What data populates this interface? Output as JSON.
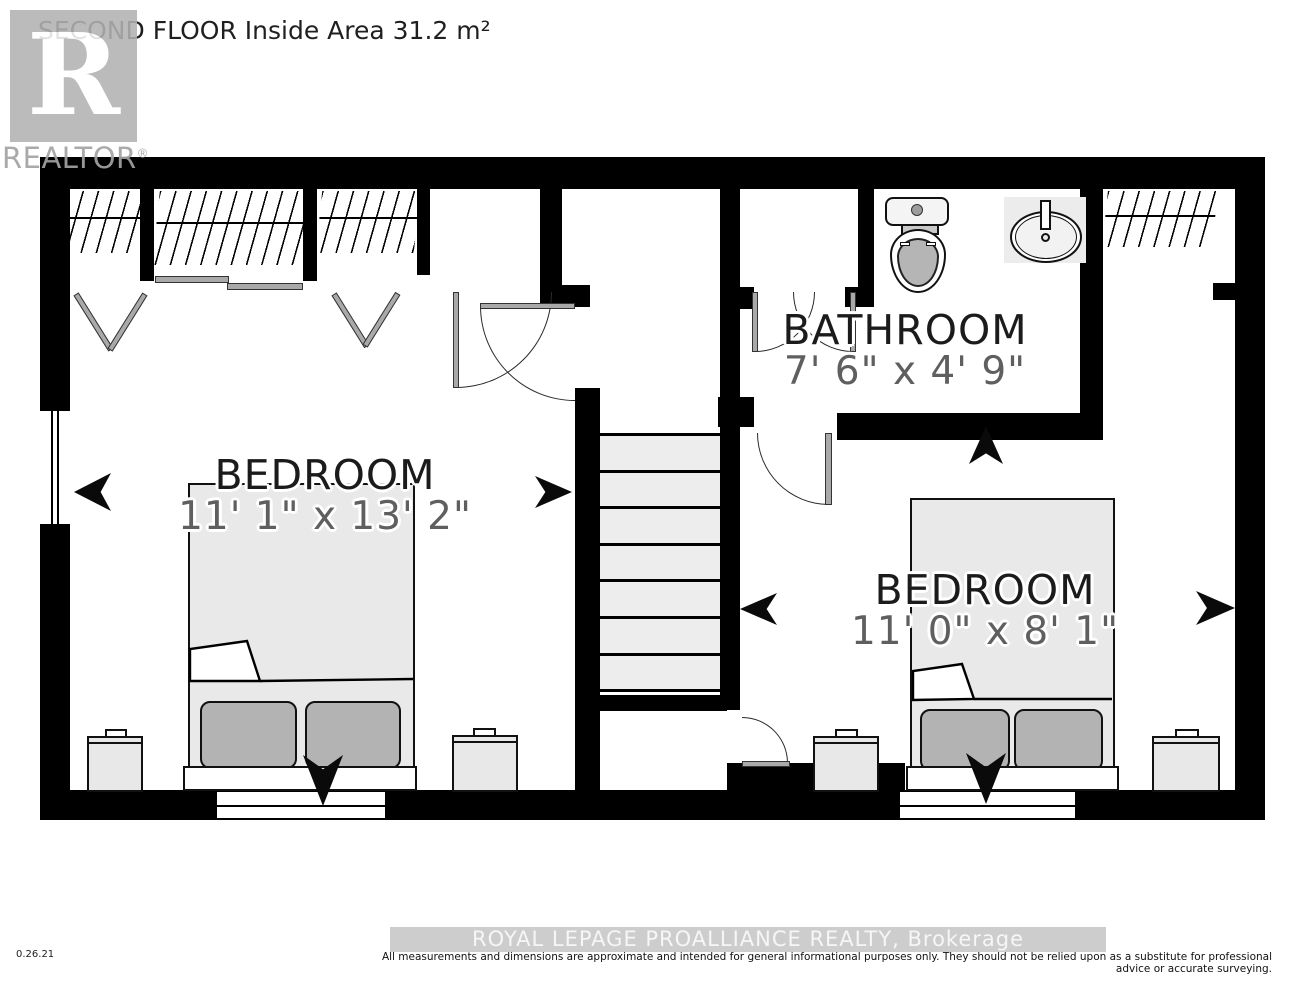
{
  "title": "SECOND FLOOR Inside Area 31.2 m²",
  "logo": {
    "letter": "R",
    "label": "REALTOR",
    "registered": "®"
  },
  "rooms": [
    {
      "name": "BEDROOM",
      "dims": "11' 1\" x 13' 2\""
    },
    {
      "name": "BATHROOM",
      "dims": "7' 6\" x 4' 9\""
    },
    {
      "name": "BEDROOM",
      "dims": "11' 0\" x 8' 1\""
    }
  ],
  "fixtures": [
    "toilet",
    "sink",
    "stairs",
    "closets",
    "beds",
    "nightstands"
  ],
  "colors": {
    "wall": "#000000",
    "furniture_fill": "#e9e9e9",
    "pillow_fill": "#b3b3b3",
    "dim_text": "#5f5f5f",
    "logo_gray": "#b2b2b2",
    "watermark_bg": "#cdcdcd"
  },
  "footer": {
    "version": "0.26.21",
    "watermark": "ROYAL LEPAGE PROALLIANCE REALTY, Brokerage",
    "disclaimer": "All measurements and dimensions are approximate and intended for general informational purposes only. They should not be relied upon as a substitute for professional advice or accurate surveying."
  }
}
